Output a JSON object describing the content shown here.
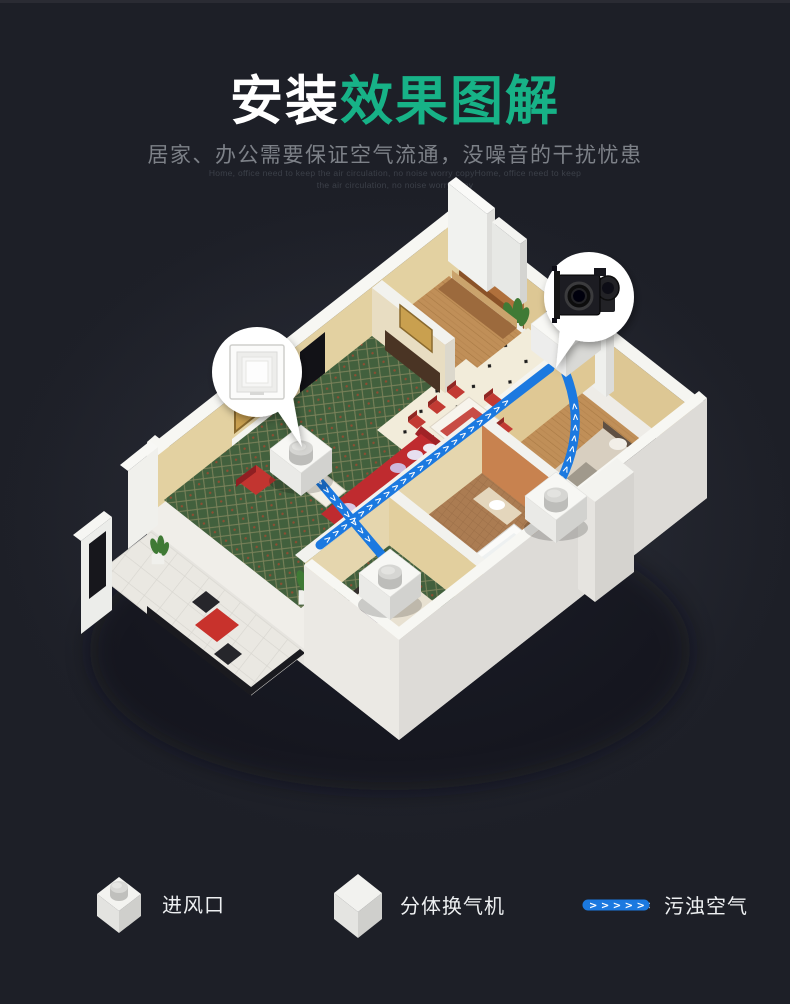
{
  "colors": {
    "background": "#1d1f27",
    "accent_green": "#17b287",
    "airflow_blue": "#1b79e0",
    "title_white": "#ffffff",
    "subtitle_gray": "#7d8188",
    "caption_gray": "#3c4049",
    "legend_text": "#eef0f2"
  },
  "header": {
    "title_segments": [
      {
        "text": "安装",
        "color": "#ffffff"
      },
      {
        "text": "效果图解",
        "color": "#17b287"
      }
    ],
    "subtitle": "居家、办公需要保证空气流通，没噪音的干扰忧患",
    "caption_en_line1": "Home, office need to keep the air circulation, no noise worry copyHome, office need to keep",
    "caption_en_line2": "the air circulation, no noise worry copy"
  },
  "illustration": {
    "callouts": [
      {
        "name": "air-inlet-panel",
        "side": "left"
      },
      {
        "name": "split-ventilator-fan",
        "side": "right"
      }
    ]
  },
  "legend": {
    "items": [
      {
        "icon": "air-inlet-cube-icon",
        "label": "进风口"
      },
      {
        "icon": "split-ventilator-cube-icon",
        "label": "分体换气机"
      },
      {
        "icon": "airflow-arrow-icon",
        "label": "污浊空气"
      }
    ]
  }
}
